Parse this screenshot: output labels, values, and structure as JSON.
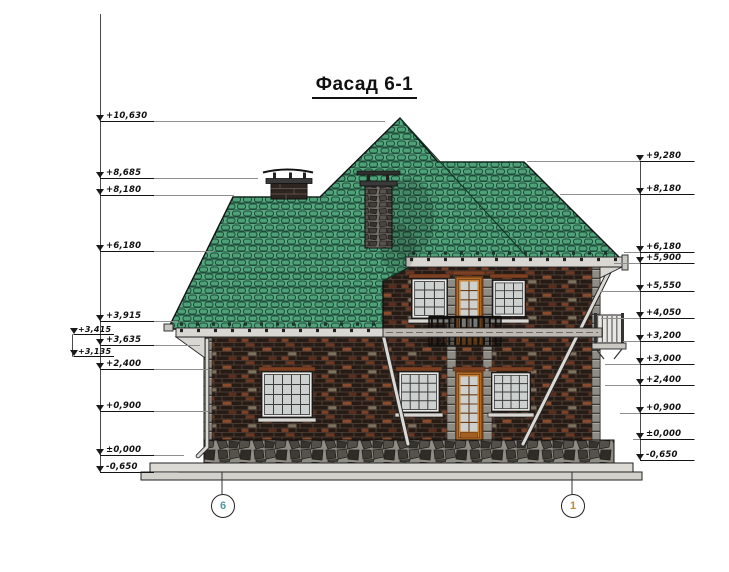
{
  "title": "Фасад 6-1",
  "colors": {
    "roof_green": "#58A87F",
    "roof_line": "#1D4A37",
    "brick_dark": "#261B15",
    "door_orange": "#B06A28",
    "stone_gray": "#8F8B85",
    "trim_light": "#D9D7D2"
  },
  "left_marks": [
    {
      "label": "+10,630",
      "y": 122,
      "x1": 100,
      "x2": 385,
      "ax": 100,
      "tx": 106
    },
    {
      "label": "+8,685",
      "y": 179,
      "x1": 100,
      "x2": 258,
      "ax": 100,
      "tx": 106
    },
    {
      "label": "+8,180",
      "y": 196,
      "x1": 100,
      "x2": 234,
      "ax": 100,
      "tx": 106
    },
    {
      "label": "+6,180",
      "y": 252,
      "x1": 100,
      "x2": 214,
      "ax": 100,
      "tx": 106
    },
    {
      "label": "+3,915",
      "y": 322,
      "x1": 100,
      "x2": 178,
      "ax": 100,
      "tx": 106
    },
    {
      "label": "+3,415",
      "y": 335,
      "x1": 72,
      "x2": 112,
      "ax": 74,
      "tx": 78,
      "offset": 1
    },
    {
      "label": "+3,635",
      "y": 346,
      "x1": 100,
      "x2": 200,
      "ax": 100,
      "tx": 106
    },
    {
      "label": "+3,135",
      "y": 357,
      "x1": 72,
      "x2": 112,
      "ax": 74,
      "tx": 78,
      "offset": 1
    },
    {
      "label": "+2,400",
      "y": 370,
      "x1": 100,
      "x2": 208,
      "ax": 100,
      "tx": 106
    },
    {
      "label": "+0,900",
      "y": 412,
      "x1": 100,
      "x2": 208,
      "ax": 100,
      "tx": 106
    },
    {
      "label": "±0,000",
      "y": 456,
      "x1": 100,
      "x2": 184,
      "ax": 100,
      "tx": 106
    },
    {
      "label": "-0,650",
      "y": 473,
      "x1": 100,
      "x2": 178,
      "ax": 100,
      "tx": 106
    }
  ],
  "right_marks": [
    {
      "label": "+9,280",
      "y": 162,
      "x1": 527,
      "x2": 695,
      "ax": 640,
      "tx": 646
    },
    {
      "label": "+8,180",
      "y": 195,
      "x1": 560,
      "x2": 695,
      "ax": 640,
      "tx": 646
    },
    {
      "label": "+6,180",
      "y": 253,
      "x1": 624,
      "x2": 695,
      "ax": 640,
      "tx": 646
    },
    {
      "label": "+5,900",
      "y": 264,
      "x1": 614,
      "x2": 695,
      "ax": 640,
      "tx": 646
    },
    {
      "label": "+5,550",
      "y": 292,
      "x1": 601,
      "x2": 695,
      "ax": 640,
      "tx": 646
    },
    {
      "label": "+4,050",
      "y": 319,
      "x1": 601,
      "x2": 695,
      "ax": 640,
      "tx": 646
    },
    {
      "label": "+3,200",
      "y": 342,
      "x1": 623,
      "x2": 695,
      "ax": 640,
      "tx": 646
    },
    {
      "label": "+3,000",
      "y": 365,
      "x1": 605,
      "x2": 695,
      "ax": 640,
      "tx": 646
    },
    {
      "label": "+2,400",
      "y": 386,
      "x1": 605,
      "x2": 695,
      "ax": 640,
      "tx": 646
    },
    {
      "label": "+0,900",
      "y": 414,
      "x1": 620,
      "x2": 695,
      "ax": 640,
      "tx": 646
    },
    {
      "label": "±0,000",
      "y": 440,
      "x1": 633,
      "x2": 695,
      "ax": 640,
      "tx": 646
    },
    {
      "label": "-0,650",
      "y": 461,
      "x1": 643,
      "x2": 695,
      "ax": 640,
      "tx": 646
    }
  ],
  "axis_bubbles": [
    {
      "label": "6",
      "x": 222,
      "color": "#4d9aa0"
    },
    {
      "label": "1",
      "x": 572,
      "color": "#c08a2e"
    }
  ]
}
